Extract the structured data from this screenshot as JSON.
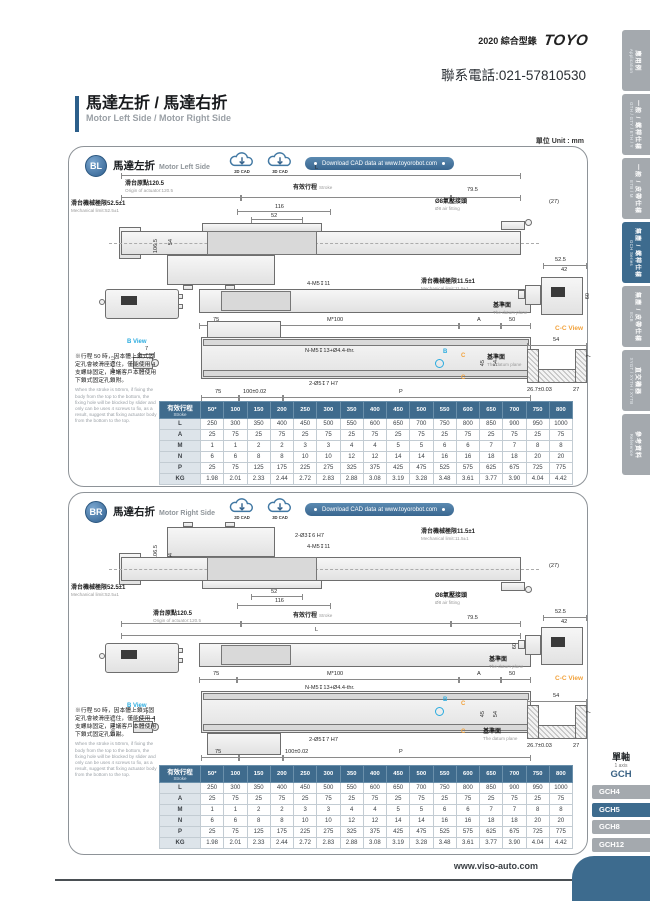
{
  "page": {
    "header": {
      "catalog": "2020 綜合型錄",
      "brand": "TOYO",
      "phone": "聯系電話:021-57810530"
    },
    "title": {
      "zh": "馬達左折 / 馬達右折",
      "en": "Motor Left Side / Motor Right Side"
    },
    "unit_label": "單位 Unit : mm"
  },
  "sidebar": {
    "tabs": [
      {
        "zh": "應用例",
        "en": "Application",
        "active": false
      },
      {
        "zh": "一般 / 螺桿仕樣",
        "en": "GTH / GTY / ETH / Y",
        "active": false
      },
      {
        "zh": "一般 / 皮帶仕樣",
        "en": "ETB / M",
        "active": false
      },
      {
        "zh": "無塵 / 螺桿仕樣",
        "en": "GCH Series",
        "active": true
      },
      {
        "zh": "無塵 / 皮帶仕樣",
        "en": "ECB",
        "active": false
      },
      {
        "zh": "直交機器",
        "en": "XYGT / XYTH / XYTB",
        "active": false
      },
      {
        "zh": "參考資料",
        "en": "Reference",
        "active": false
      }
    ]
  },
  "sections": {
    "bl": {
      "code": "BL",
      "title_zh": "馬達左折",
      "title_en": "Motor Left Side"
    },
    "br": {
      "code": "BR",
      "title_zh": "馬達右折",
      "title_en": "Motor Right Side"
    }
  },
  "cad": {
    "cad2d": "2D CAD",
    "cad3d": "3D CAD",
    "download": "Download CAD data at www.toyorobot.com"
  },
  "dims": {
    "L": "L",
    "origin_zh": "滑台原點120.5",
    "origin_en": "Origin of actuator:120.5",
    "stroke_zh": "有效行程",
    "stroke_en": "Stroke",
    "d795": "79.5",
    "d27p": "(27)",
    "d116": "116",
    "d52": "52",
    "air_zh": "Ø8氣壓接頭",
    "air_en": "Ø8 air fitting",
    "mech52_zh": "滑台機械極限52.5±1",
    "mech52_en": "Mechanical limit:52.5±1",
    "mech11_zh": "滑台機械極限11.5±1",
    "mech11_en": "Mechanical limit:11.5±1",
    "d1065": "106.5",
    "d54": "54",
    "m5": "4-M5↧11",
    "h3": "2-Ø3↧6 H7",
    "d75": "75",
    "m100": "M*100",
    "A": "A",
    "d50": "50",
    "nm5": "N-M5↧13+Ø4.4-thr.",
    "d45": "45",
    "datum_zh": "基準面",
    "datum_en": "The datum plane",
    "h5": "2-Ø5↧7 H7",
    "d100": "100±0.02",
    "P": "P",
    "d525": "52.5",
    "d42": "42",
    "d60": "60",
    "cc_view": "C-C View",
    "b_view": "B View",
    "B": "B",
    "C": "C",
    "d267": "26.7±0.03",
    "d27": "27",
    "d7": "7",
    "btol1": "5+0.012",
    "btol2": "0"
  },
  "note": {
    "zh": "※行程 50 時，因本體上鎖式固定孔會被滑座遮住，僅能使用 4 支螺絲固定，建議客戶本體使用下鎖式固定孔鎖附。",
    "en": "When the stroke is 50mm, if fixing the body from the top to the bottom, the fixing hole will be blocked by slider and only can be uses 4 screws to fix, as a result, suggest that fixing actuator body from the bottom to the top."
  },
  "table": {
    "header_label_zh": "有效行程",
    "header_label_en": "Stroke",
    "strokes": [
      "50*",
      "100",
      "150",
      "200",
      "250",
      "300",
      "350",
      "400",
      "450",
      "500",
      "550",
      "600",
      "650",
      "700",
      "750",
      "800"
    ],
    "rows": [
      {
        "label": "L",
        "values": [
          "250",
          "300",
          "350",
          "400",
          "450",
          "500",
          "550",
          "600",
          "650",
          "700",
          "750",
          "800",
          "850",
          "900",
          "950",
          "1000"
        ]
      },
      {
        "label": "A",
        "values": [
          "25",
          "75",
          "25",
          "75",
          "25",
          "75",
          "25",
          "75",
          "25",
          "75",
          "25",
          "75",
          "25",
          "75",
          "25",
          "75"
        ]
      },
      {
        "label": "M",
        "values": [
          "1",
          "1",
          "2",
          "2",
          "3",
          "3",
          "4",
          "4",
          "5",
          "5",
          "6",
          "6",
          "7",
          "7",
          "8",
          "8"
        ]
      },
      {
        "label": "N",
        "values": [
          "6",
          "6",
          "8",
          "8",
          "10",
          "10",
          "12",
          "12",
          "14",
          "14",
          "16",
          "16",
          "18",
          "18",
          "20",
          "20"
        ]
      },
      {
        "label": "P",
        "values": [
          "25",
          "75",
          "125",
          "175",
          "225",
          "275",
          "325",
          "375",
          "425",
          "475",
          "525",
          "575",
          "625",
          "675",
          "725",
          "775"
        ]
      },
      {
        "label": "KG",
        "values": [
          "1.98",
          "2.01",
          "2.33",
          "2.44",
          "2.72",
          "2.83",
          "2.88",
          "3.08",
          "3.19",
          "3.28",
          "3.48",
          "3.61",
          "3.77",
          "3.90",
          "4.04",
          "4.42"
        ]
      }
    ]
  },
  "series_nav": {
    "axis_zh": "單軸",
    "axis_en": "1 axis",
    "family": "GCH",
    "items": [
      {
        "label": "GCH4",
        "active": false
      },
      {
        "label": "GCH5",
        "active": true
      },
      {
        "label": "GCH8",
        "active": false
      },
      {
        "label": "GCH12",
        "active": false
      }
    ]
  },
  "footer": {
    "website": "www.viso-auto.com"
  }
}
